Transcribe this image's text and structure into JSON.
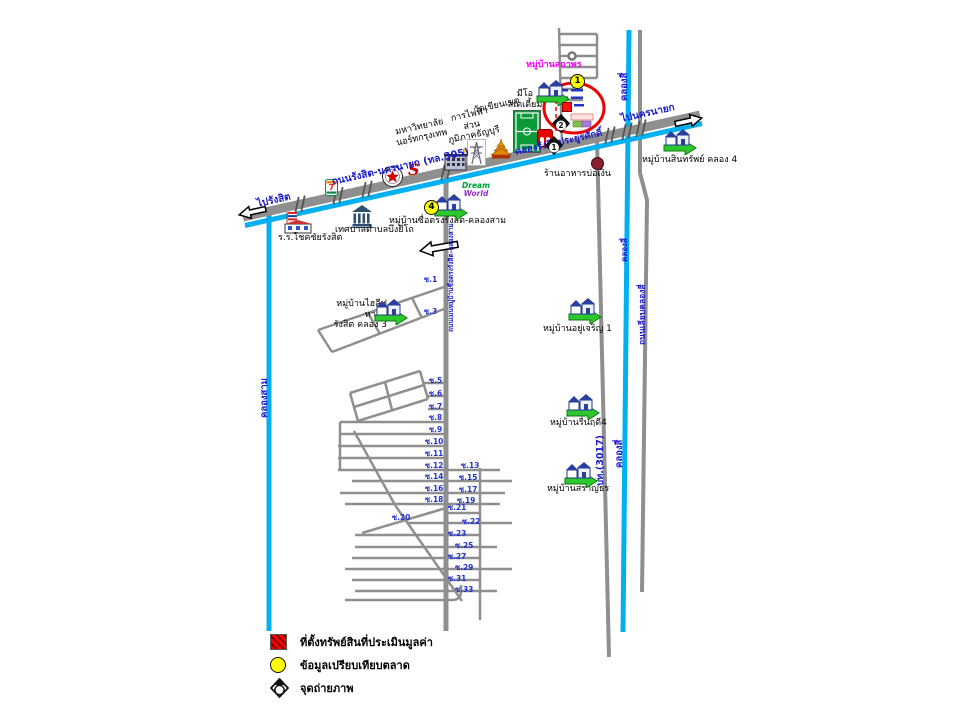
{
  "map_title": "แผนที่แสดงที่ตั้งทรัพย์สิน ถนนรังสิต-นครนายก",
  "colors": {
    "road_gray": "#8f8f8f",
    "canal_cyan": "#00b0f0",
    "label_blue": "#1a1acc",
    "highlight_red": "#ee0000",
    "marker_yellow": "#ffff00",
    "village_label_magenta": "#ff00ff"
  },
  "legend": {
    "items": [
      {
        "symbol": "red-hatched-square",
        "label": "ที่ตั้งทรัพย์สินที่ประเมินมูลค่า"
      },
      {
        "symbol": "yellow-circle",
        "label": "ข้อมูลเปรียบเทียบตลาด"
      },
      {
        "symbol": "camera",
        "label": "จุดถ่ายภาพ"
      }
    ]
  },
  "labels": [
    {
      "t": "ถนนรังสิต-นครนายก (ทล.305)",
      "x": 331,
      "y": 177,
      "r": -12.5,
      "cls": "blue"
    },
    {
      "t": "ไปรังสิต",
      "x": 256,
      "y": 199,
      "r": -12.5,
      "cls": "blue"
    },
    {
      "t": "ไปนครนายก",
      "x": 620,
      "y": 114,
      "r": -12.5,
      "cls": "blue"
    },
    {
      "t": "คลองรังสิตประยูรศักดิ์",
      "x": 514,
      "y": 147,
      "r": -12.5,
      "cls": "blue",
      "fs": 9.5
    },
    {
      "t": "คลองสาม",
      "x": 259,
      "y": 418,
      "r": -90,
      "cls": "blue",
      "fs": 9.5
    },
    {
      "t": "คลองสี่",
      "x": 619,
      "y": 101,
      "r": -90,
      "cls": "blue",
      "fs": 9.5
    },
    {
      "t": "คลองสี่",
      "x": 620,
      "y": 262,
      "r": -90,
      "cls": "blue",
      "fs": 8
    },
    {
      "t": "คลองสี่",
      "x": 614,
      "y": 468,
      "r": -90,
      "cls": "blue",
      "fs": 9.5
    },
    {
      "t": "ปท.(3017)",
      "x": 595,
      "y": 486,
      "r": -90,
      "cls": "blue",
      "fs": 9.5
    },
    {
      "t": "ถนนเลียบคลองสี่",
      "x": 638,
      "y": 345,
      "r": -90,
      "cls": "blue",
      "fs": 8.5
    },
    {
      "t": "ถนนเมนหมู่บ้านซื่อตรงรังสิต-คลองสาม",
      "x": 448,
      "y": 332,
      "r": -90,
      "cls": "blue",
      "fs": 6.5
    },
    {
      "t": "ร.ร.โชคชัยรังสิต",
      "x": 278,
      "y": 233
    },
    {
      "t": "เทศบาลตำบลบึงยี่โถ",
      "x": 335,
      "y": 225
    },
    {
      "t": "มหาวิทยาลัย\nนอร์ทกรุงเทพ",
      "x": 393,
      "y": 128,
      "r": -12.5,
      "al": "center",
      "w": 52
    },
    {
      "t": "การไฟฟ้าส่วน\nภูมิภาคธัญบุรี",
      "x": 442,
      "y": 116,
      "r": -12.5,
      "al": "center",
      "w": 54
    },
    {
      "t": "วัดเขียนเขต",
      "x": 473,
      "y": 106,
      "r": -12.5
    },
    {
      "t": "มีโอ\nสเตเดี้ยม",
      "x": 503,
      "y": 89,
      "al": "center",
      "w": 44
    },
    {
      "t": "ร้านอาหารบ่อเงิน",
      "x": 544,
      "y": 169
    },
    {
      "t": "หมู่บ้านสินทรัพย์ คลอง 4",
      "x": 642,
      "y": 155
    },
    {
      "t": "หมู่บ้านซื่อตรงรังสิต-คลองสาม",
      "x": 389,
      "y": 216
    },
    {
      "t": "หมู่บ้านไฮลีฟ ทาวน์\nรังสิต คลอง 3",
      "x": 313,
      "y": 299,
      "al": "right",
      "w": 74
    },
    {
      "t": "หมู่บ้านอยู่เจริญ 1",
      "x": 543,
      "y": 324
    },
    {
      "t": "หมู่บ้านรื่นฤดี4",
      "x": 550,
      "y": 418
    },
    {
      "t": "หมู่บ้านสราญธร",
      "x": 547,
      "y": 484
    },
    {
      "t": "หมู่บ้านสถาพร",
      "x": 526,
      "y": 60,
      "cls": "magenta"
    }
  ],
  "sois": [
    {
      "t": "ซ.1",
      "x": 424,
      "y": 274
    },
    {
      "t": "ซ.3",
      "x": 424,
      "y": 306
    },
    {
      "t": "ซ.5",
      "x": 429,
      "y": 375
    },
    {
      "t": "ซ.6",
      "x": 429,
      "y": 388
    },
    {
      "t": "ซ.7",
      "x": 429,
      "y": 401
    },
    {
      "t": "ซ.8",
      "x": 429,
      "y": 412
    },
    {
      "t": "ซ.9",
      "x": 429,
      "y": 424
    },
    {
      "t": "ซ.10",
      "x": 425,
      "y": 436
    },
    {
      "t": "ซ.11",
      "x": 425,
      "y": 448
    },
    {
      "t": "ซ.12",
      "x": 425,
      "y": 460
    },
    {
      "t": "ซ.13",
      "x": 461,
      "y": 460
    },
    {
      "t": "ซ.14",
      "x": 425,
      "y": 471
    },
    {
      "t": "ซ.15",
      "x": 459,
      "y": 472
    },
    {
      "t": "ซ.16",
      "x": 425,
      "y": 483
    },
    {
      "t": "ซ.17",
      "x": 459,
      "y": 484
    },
    {
      "t": "ซ.18",
      "x": 425,
      "y": 494
    },
    {
      "t": "ซ.19",
      "x": 457,
      "y": 495
    },
    {
      "t": "ซ.20",
      "x": 392,
      "y": 512
    },
    {
      "t": "ซ.21",
      "x": 448,
      "y": 502
    },
    {
      "t": "ซ.22",
      "x": 462,
      "y": 516
    },
    {
      "t": "ซ.23",
      "x": 448,
      "y": 528
    },
    {
      "t": "ซ.25",
      "x": 455,
      "y": 540
    },
    {
      "t": "ซ.27",
      "x": 448,
      "y": 551
    },
    {
      "t": "ซ.29",
      "x": 455,
      "y": 562
    },
    {
      "t": "ซ.31",
      "x": 448,
      "y": 573
    },
    {
      "t": "ซ.33",
      "x": 455,
      "y": 584
    }
  ],
  "village_icons": [
    {
      "id": "sathaporn",
      "x": 535,
      "y": 79
    },
    {
      "id": "sinsap-khlong4",
      "x": 662,
      "y": 128
    },
    {
      "id": "suetrong",
      "x": 433,
      "y": 193
    },
    {
      "id": "hilife-town",
      "x": 373,
      "y": 298
    },
    {
      "id": "yu-charoen-1",
      "x": 567,
      "y": 297
    },
    {
      "id": "ruen-rudee-4",
      "x": 565,
      "y": 393
    },
    {
      "id": "saranthorn",
      "x": 563,
      "y": 461
    }
  ],
  "markers": {
    "yellow_comparables": [
      {
        "n": "1",
        "x": 570,
        "y": 74
      },
      {
        "n": "4",
        "x": 424,
        "y": 200
      }
    ],
    "cameras": [
      {
        "n": "2",
        "x": 552,
        "y": 114
      },
      {
        "n": "1",
        "x": 545,
        "y": 136
      }
    ],
    "property_square": {
      "x": 562,
      "y": 102
    }
  },
  "icon_glyphs": {
    "seven_eleven": "7",
    "suzuki": "S",
    "dream_line1": "Dream",
    "dream_line2": "World"
  }
}
